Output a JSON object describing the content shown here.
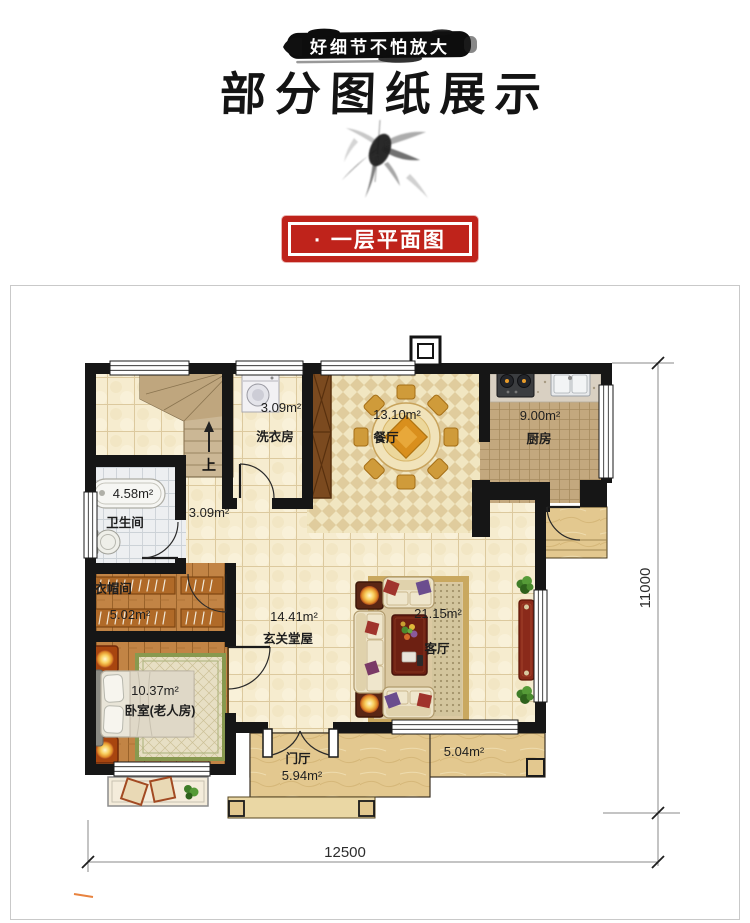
{
  "header": {
    "banner": "好细节不怕放大",
    "title": "部分图纸展示",
    "stamp": "· 一层平面图"
  },
  "plan": {
    "stair_up": "上",
    "labels": {
      "laundry_area": "3.09m²",
      "laundry_name": "洗衣房",
      "dining_area": "13.10m²",
      "dining_name": "餐厅",
      "kitchen_area": "9.00m²",
      "kitchen_name": "厨房",
      "bath_area": "4.58m²",
      "bath_name": "卫生间",
      "hall_area": "3.09m²",
      "cloak_name": "衣帽间",
      "cloak_area": "5.02m²",
      "entry_area": "14.41m²",
      "entry_name": "玄关堂屋",
      "living_area": "21.15m²",
      "living_name": "客厅",
      "bedroom_area": "10.37m²",
      "bedroom_name": "卧室(老人房)",
      "foyer_name": "门厅",
      "foyer_area": "5.94m²",
      "porch_area": "5.04m²"
    },
    "dimensions": {
      "width": "12500",
      "height": "11000"
    }
  },
  "colors": {
    "stamp_red": "#bf231b",
    "wall": "#161616",
    "wood": "#c28445",
    "tile": "#f6eccf"
  }
}
